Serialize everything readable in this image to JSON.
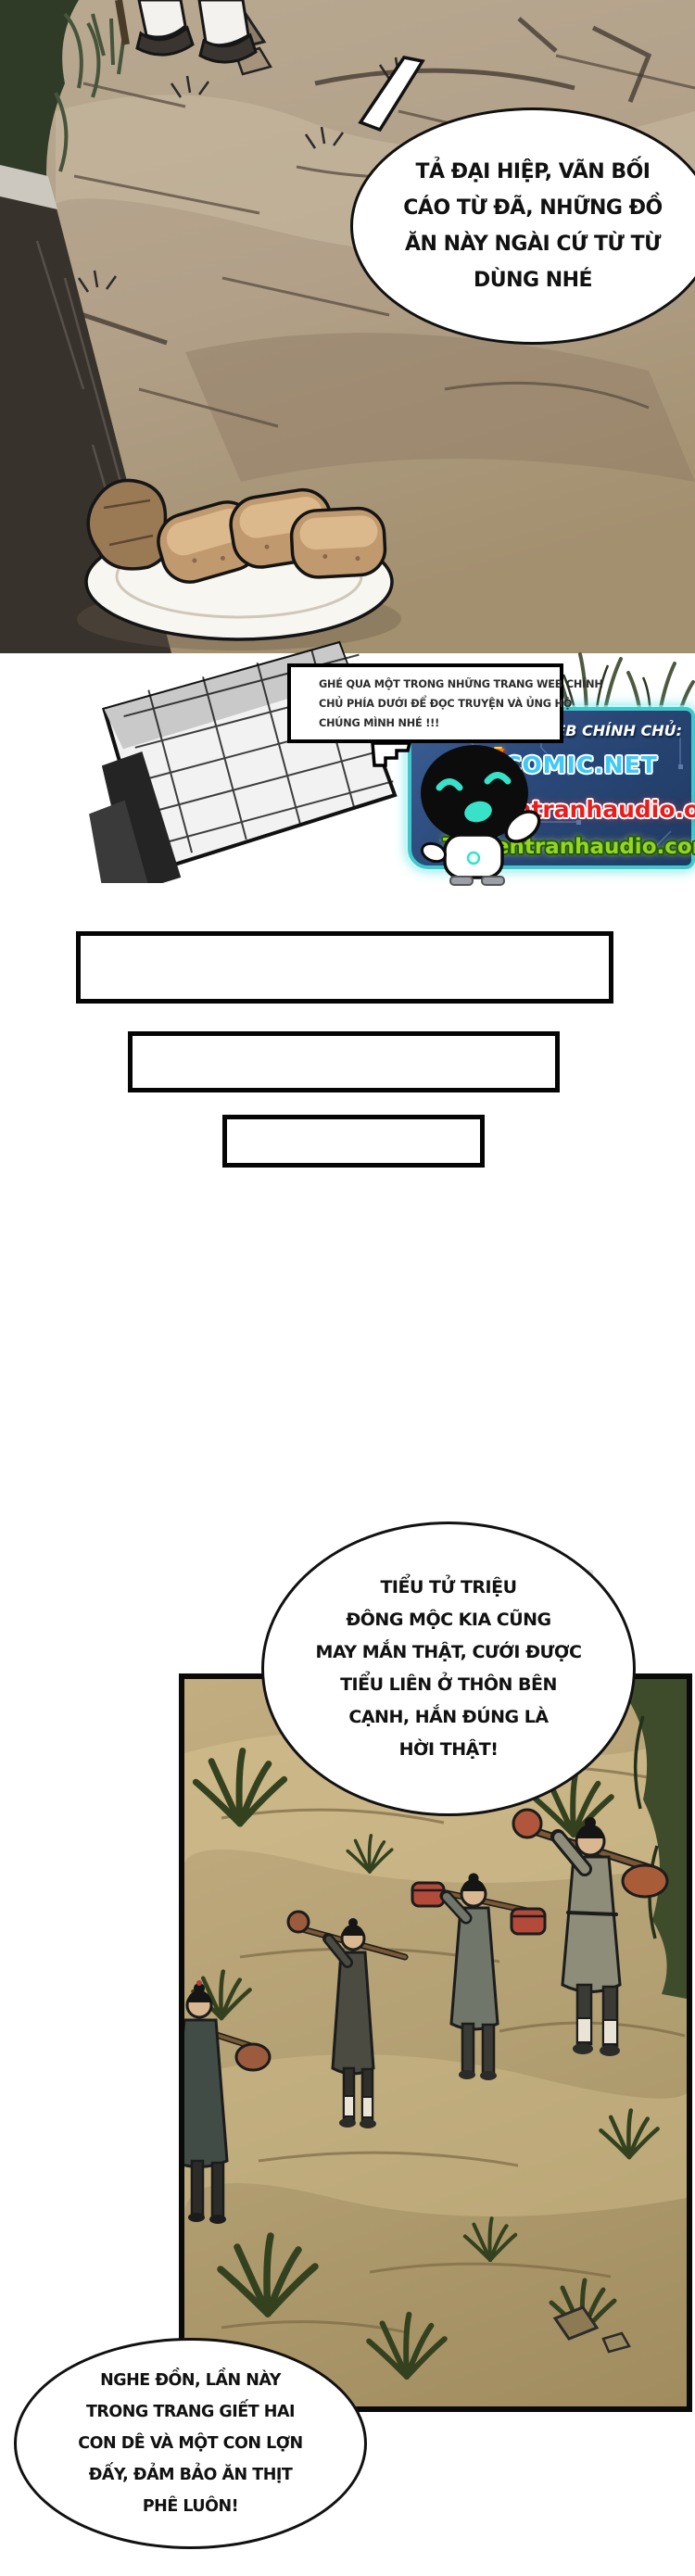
{
  "panel1": {
    "bubble_lines": [
      "TẢ ĐẠI HIỆP, VÃN BỐI",
      "CÁO TỪ ĐÃ, NHỮNG ĐỒ",
      "ĂN NÀY NGÀI CỨ TỪ TỪ",
      "DÙNG NHÉ"
    ]
  },
  "watermark": "腾讯动漫",
  "ad": {
    "bubble_lines": [
      "GHÉ QUA MỘT TRONG NHỮNG TRANG WEB CHÍNH",
      "CHỦ PHÍA DƯỚI ĐỂ ĐỌC TRUYỆN VÀ ỦNG HỘ",
      "CHÚNG MÌNH NHÉ !!!"
    ],
    "web_label": "WEB CHÍNH CHỦ:",
    "sites": {
      "vcomic_v": "V",
      "vcomic_rest": "COMIC.NET",
      "online": "Truyentranhaudio.online",
      "com": "Truyentranhaudio.com"
    },
    "colors": {
      "banner_border": "#3fc9cc",
      "banner_background": "#2a4878",
      "vcomic_v": "#ff7a00",
      "vcomic_rest": "#3fc9f5",
      "online": "#e81e1e",
      "com": "#97d426",
      "mascot_accent": "#38e2c8"
    }
  },
  "placeholder_boxes": 3,
  "panel2": {
    "bubble_lines": [
      "TIỂU TỬ TRIỆU",
      "ĐÔNG MỘC KIA CŨNG",
      "MAY MẮN THẬT, CƯỚI ĐƯỢC",
      "TIỂU LIÊN Ở THÔN BÊN",
      "CẠNH, HẮN ĐÚNG LÀ",
      "HỜI THẬT!"
    ]
  },
  "bubble_bottom": {
    "lines": [
      "NGHE ĐỒN, LẦN NÀY",
      "TRONG TRANG GIẾT HAI",
      "CON DÊ VÀ MỘT CON LỢN",
      "ĐẤY, ĐẢM BẢO ĂN THỊT",
      "PHÊ LUÔN!"
    ]
  }
}
